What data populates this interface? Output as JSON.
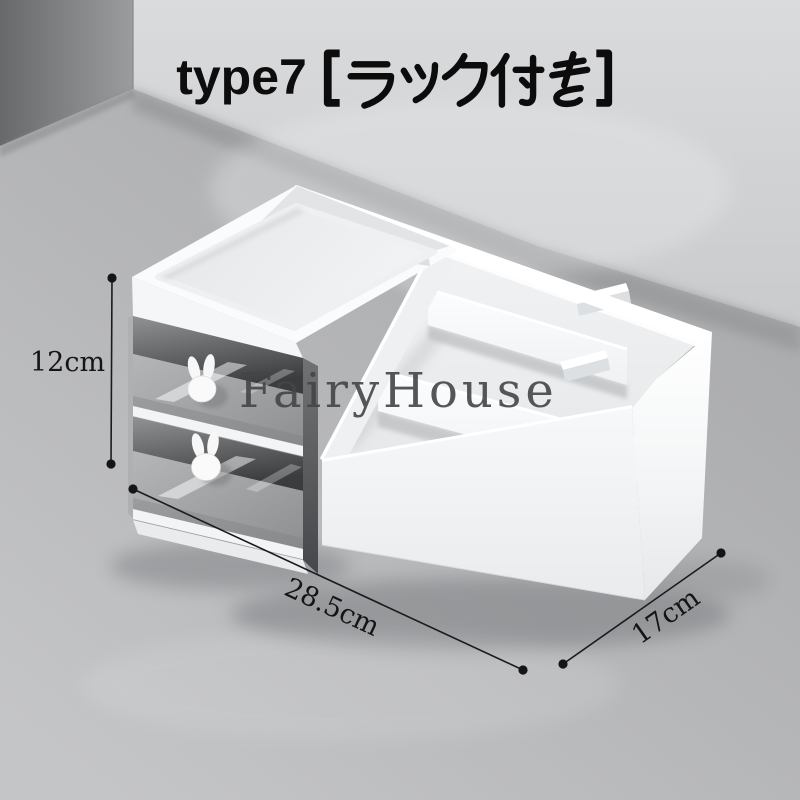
{
  "title": {
    "text": "type7【ラック付き】",
    "latin": "type7",
    "japanese": "【ラック付き】"
  },
  "watermark": "FairyHouse",
  "dimensions": {
    "height": "12cm",
    "width": "28.5cm",
    "depth": "17cm"
  },
  "colors": {
    "wall": "#d2d3d5",
    "wall_dark_corner": "#6c6d6f",
    "floor": "#b9babc",
    "product_white": "#f7f8fa",
    "drawer_panel": "#9fa1a3",
    "bunny_knob": "#fafafb",
    "title_text": "#0d0d0d",
    "watermark_text": "#454547",
    "dimension_line": "#1b1b1d"
  }
}
